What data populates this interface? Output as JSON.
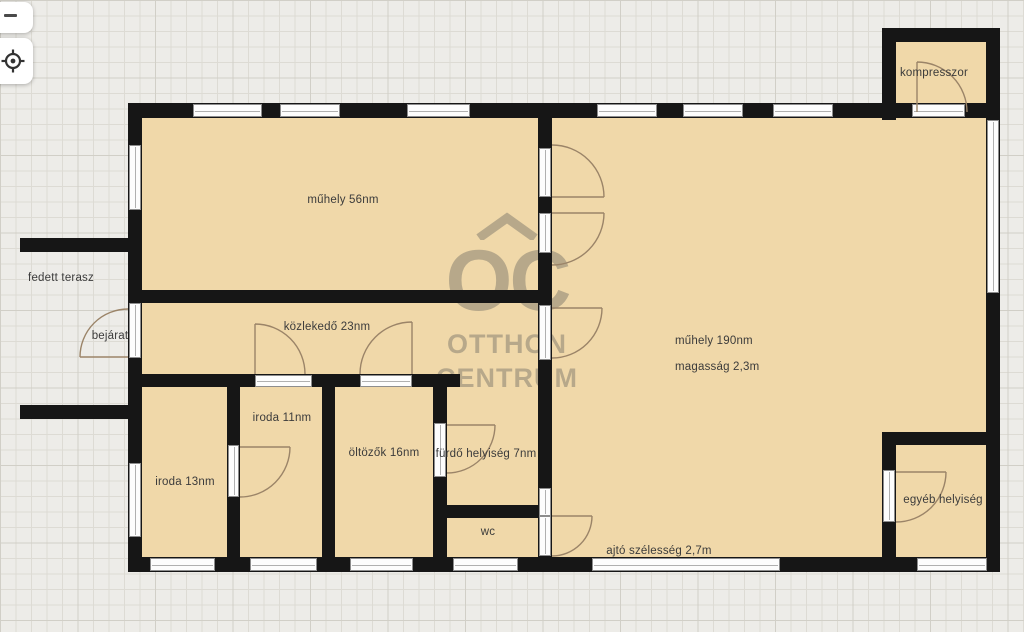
{
  "app": {
    "type": "floorplan-viewer",
    "controls": {
      "zoom_out": {
        "icon": "minus-icon"
      },
      "locate": {
        "icon": "crosshair-target-icon"
      }
    }
  },
  "plan": {
    "labels": {
      "muhely56": "műhely 56nm",
      "kozlekedo": "közlekedő 23nm",
      "iroda11": "iroda 11nm",
      "iroda13": "iroda 13nm",
      "oltozok": "öltözők 16nm",
      "furdo": "fürdő helyiség 7nm",
      "wc": "wc",
      "muhely190": "műhely 190nm",
      "magassag": "magasság 2,3m",
      "egyeb": "egyéb helyiség",
      "kompresszor": "kompresszor",
      "terasz": "fedett terasz",
      "bejarat": "bejárat",
      "ajto": "ajtó szélesség 2,7m"
    },
    "watermark": {
      "logo": "OC",
      "logo_mark": "roof-chevron-icon",
      "line1": "OTTHON",
      "line2": "CENTRUM"
    }
  },
  "colors": {
    "background": "#edece8",
    "grid_line": "#dddbd4",
    "grid_line_major": "#d1cfc7",
    "room_fill": "#f0d8a9",
    "wall": "#161616",
    "door_arc": "#9b8468",
    "label_text": "#3b3b3b",
    "watermark": "#63635d",
    "window_fill": "#fdfdfd",
    "ui_button": "#ffffff"
  }
}
